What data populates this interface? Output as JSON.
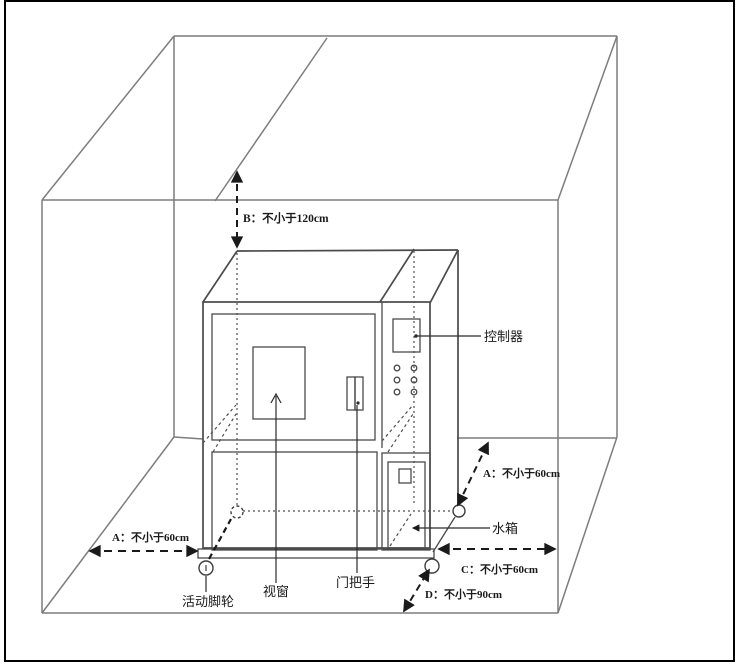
{
  "diagram": {
    "dimension_labels": {
      "b": "B：不小于120cm",
      "a_left": "A：不小于60cm",
      "a_right": "A：不小于60cm",
      "c": "C：不小于60cm",
      "d": "D：不小于90cm"
    },
    "part_labels": {
      "controller": "控制器",
      "water_tank": "水箱",
      "viewing_window": "视窗",
      "door_handle": "门把手",
      "casters": "活动脚轮"
    },
    "colors": {
      "background": "#ffffff",
      "frame_border": "#000000",
      "room_line": "#7d7d7d",
      "machine_line": "#4a4a4a",
      "dimension_line": "#1a1a1a",
      "text": "#1a1a1a"
    }
  }
}
